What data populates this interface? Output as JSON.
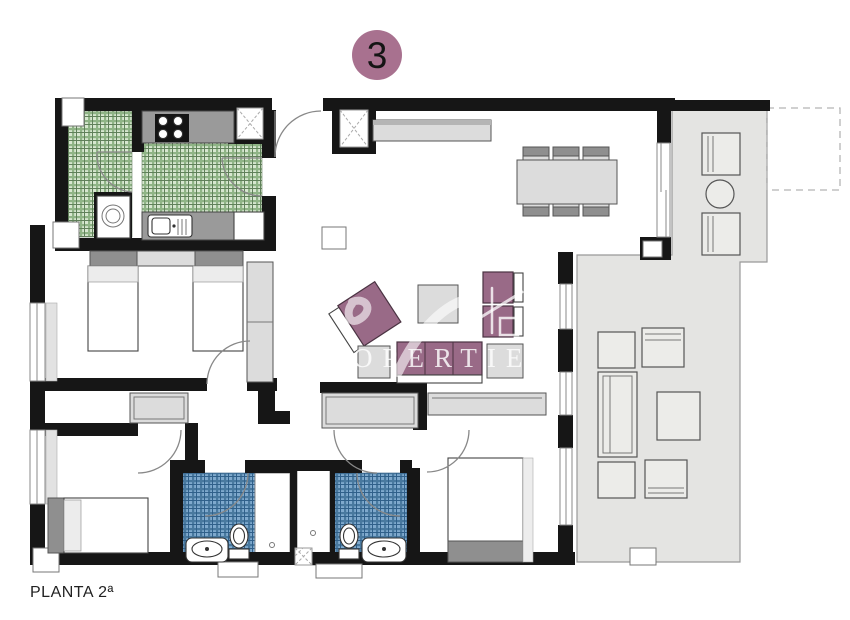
{
  "title_badge": {
    "number": "3",
    "color": "#a8718f"
  },
  "footer": {
    "plan_label": "PLANTA 2ª"
  },
  "watermark": {
    "text": "PROPERTIES",
    "color": "#ffffff"
  },
  "colors": {
    "wall": "#161616",
    "badge": "#a8718f",
    "sofa": "#996a87",
    "green_tile": "#d7e7d0",
    "green_tile_line": "#8fb486",
    "green_tile_dark": "#60805a",
    "blue_tile": "#7fa9cd",
    "blue_tile_line": "#49799f",
    "blue_tile_dark": "#30608a",
    "terrace_floor": "#e4e4e2",
    "furniture_light": "#dcdcdc",
    "furniture_dark": "#8f8f8f",
    "counter": "#9a9a9a",
    "watermark": "#ffffff",
    "background": "#ffffff"
  }
}
